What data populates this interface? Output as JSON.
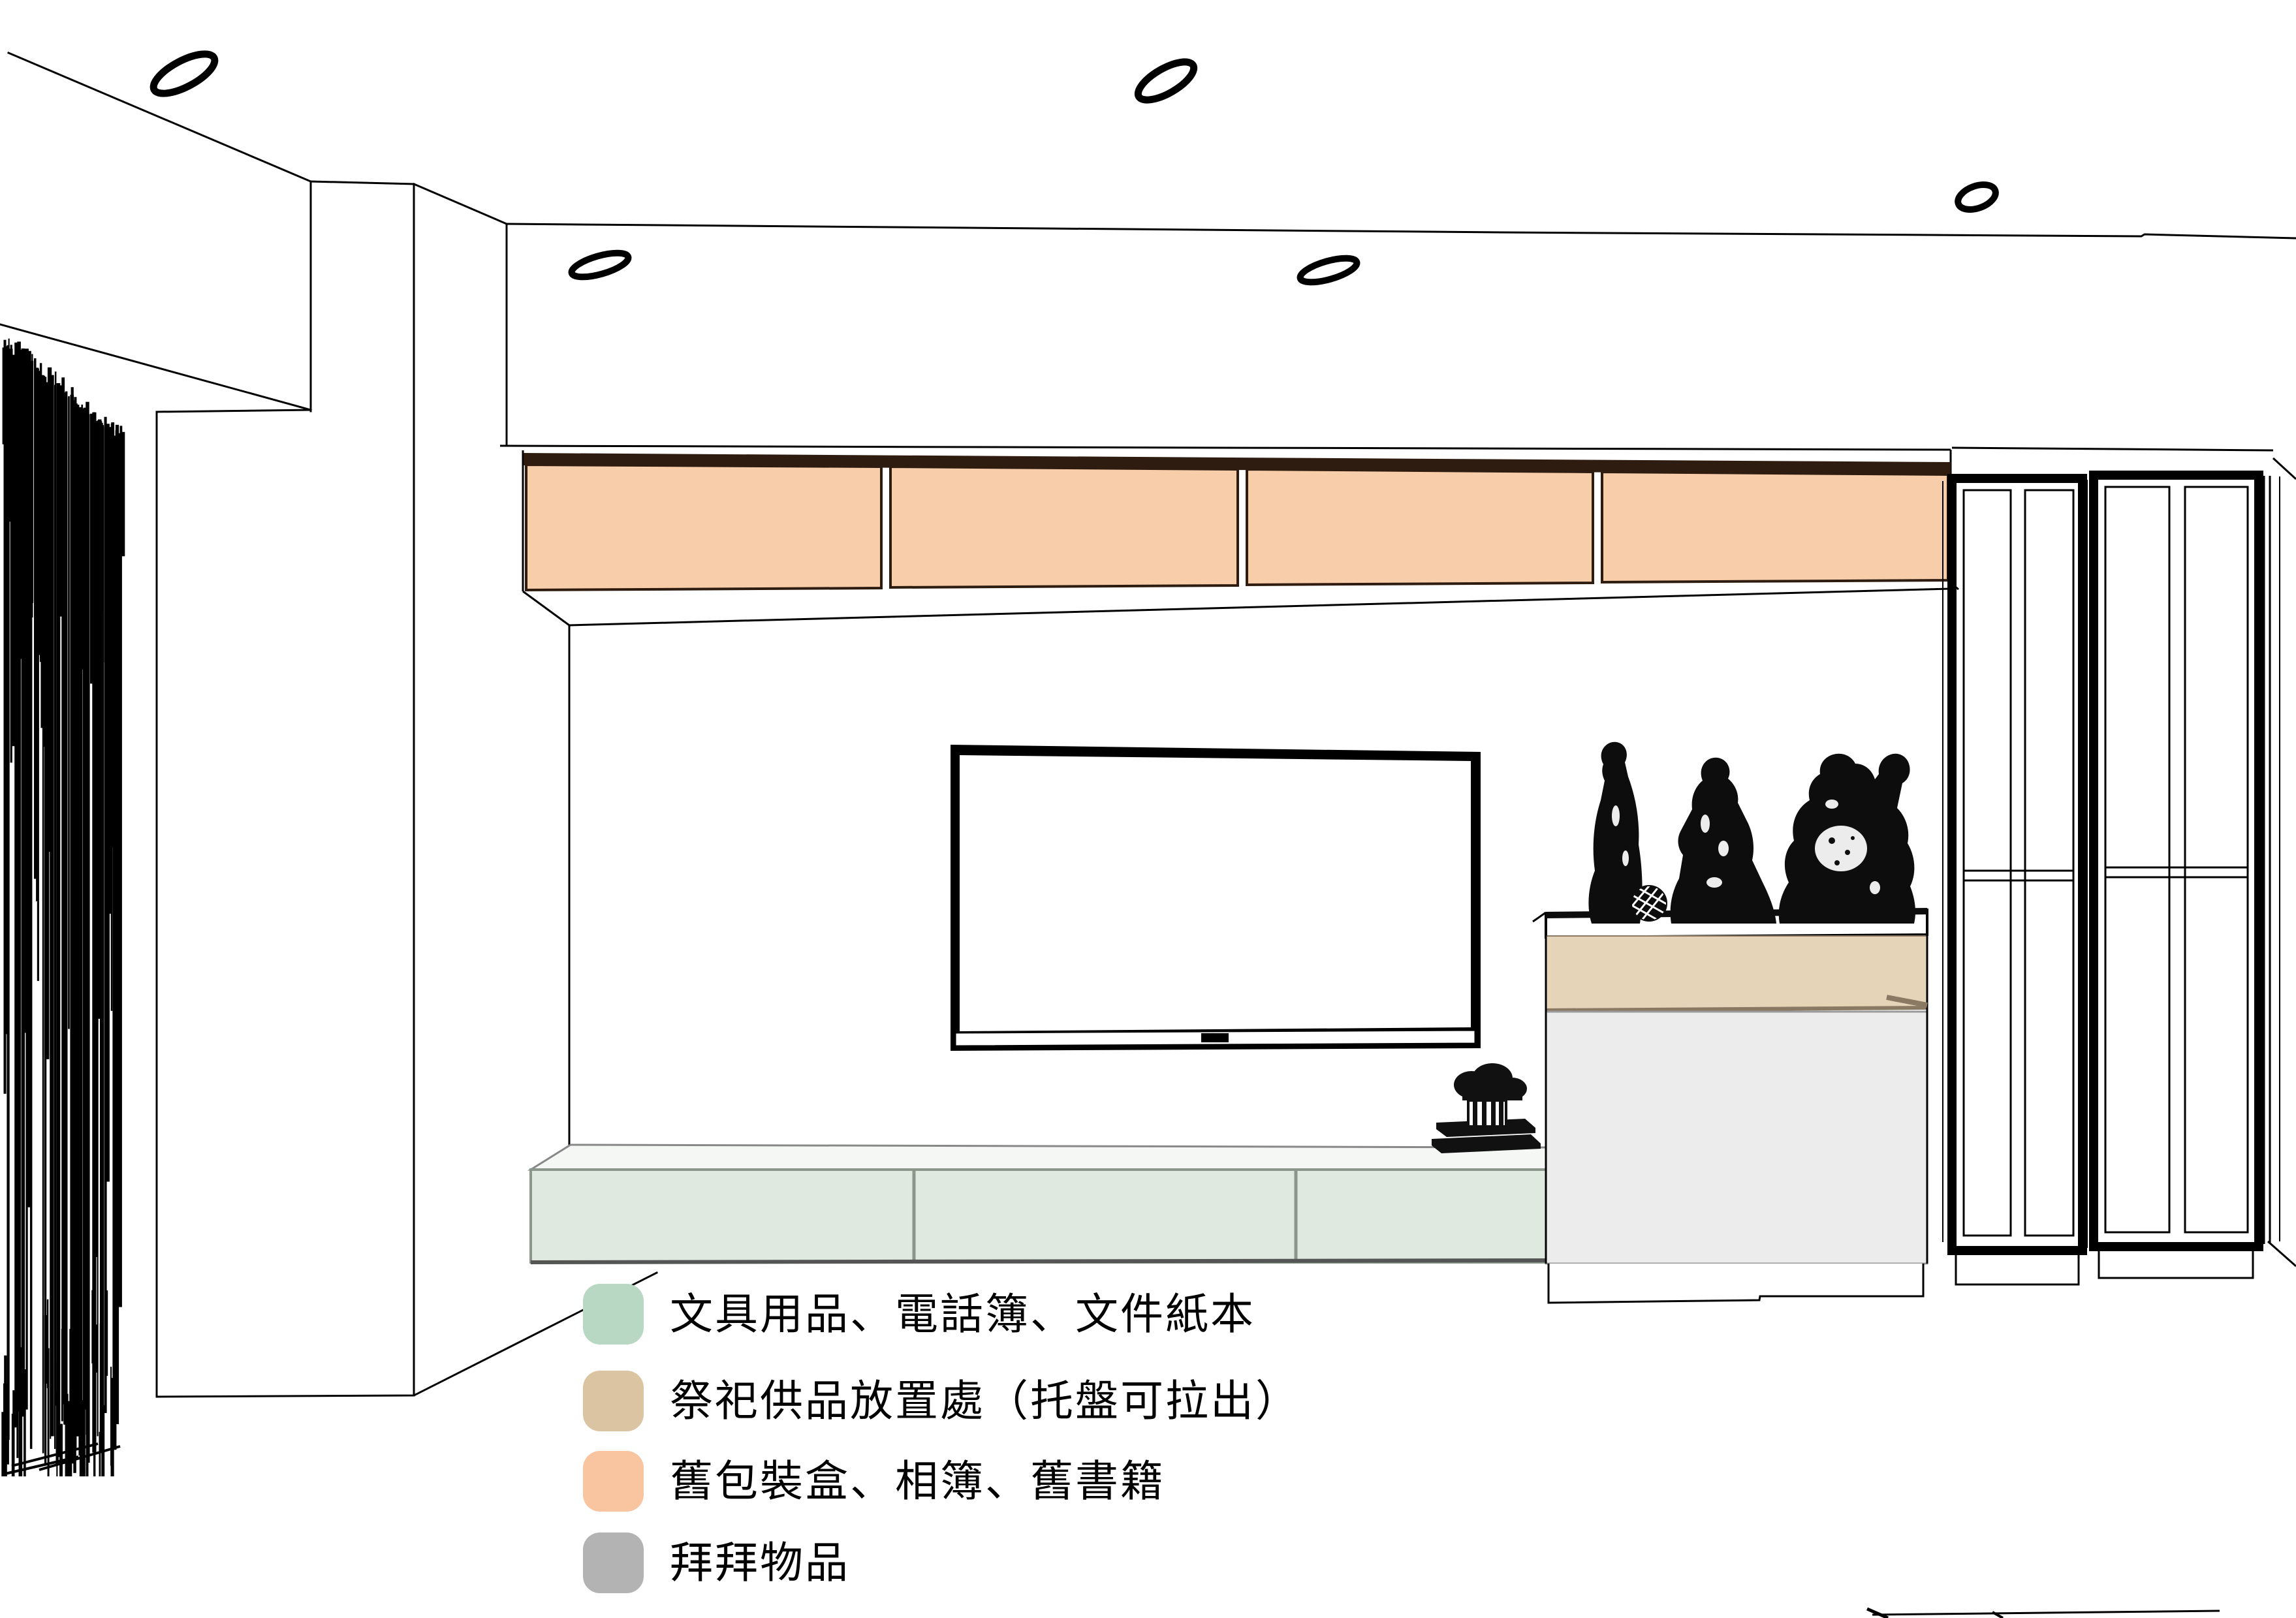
{
  "diagram": {
    "type": "interior-elevation-drawing",
    "legend": {
      "items": [
        {
          "id": "stationery",
          "label": "文具用品、電話簿、文件紙本",
          "color": "#b8d8c3"
        },
        {
          "id": "offerings",
          "label": "祭祀供品放置處（托盤可拉出）",
          "color": "#dbc4a2"
        },
        {
          "id": "old-boxes",
          "label": "舊包裝盒、相簿、舊書籍",
          "color": "#f8c5a0"
        },
        {
          "id": "worship-items",
          "label": "拜拜物品",
          "color": "#b3b3b3"
        }
      ]
    },
    "zones": {
      "upper_cabinets": "#f8cdaa",
      "upper_cabinets_edge": "#2e1c10",
      "tv_cabinet": "#e0e9e0",
      "tv_cabinet_edge": "#8b968b",
      "altar_band": "#e6d4b8",
      "altar_band_edge": "#8a7a64",
      "altar_body": "#ececec",
      "altar_body_edge": "#9a9a9a",
      "statues": "#0d0d0d",
      "line": "#000000"
    }
  }
}
